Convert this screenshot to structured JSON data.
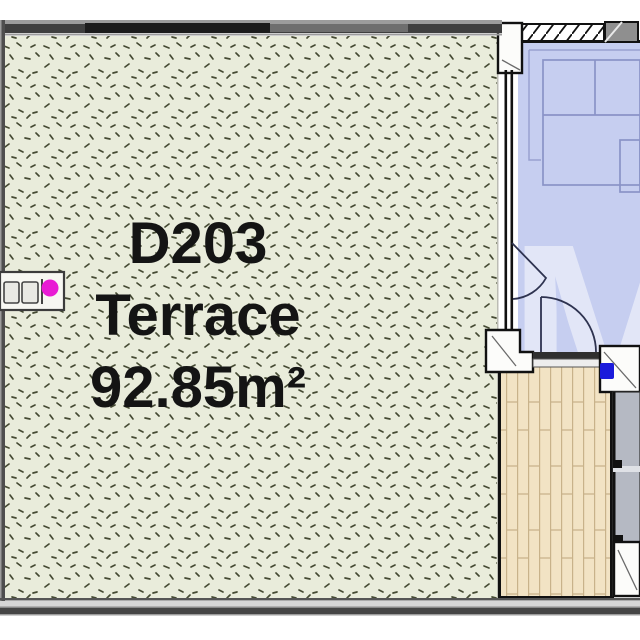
{
  "plan": {
    "unit_id": "D203",
    "room_label": "Terrace",
    "area_label": "92.85m²",
    "watermark": "M"
  },
  "icons": {
    "ac_unit": "ac-unit-icon",
    "door_swing": "door-swing-arc",
    "window_casement": "window-casement-arc"
  },
  "colors": {
    "terrace_fill": "#e9ecdb",
    "speckle": "#454a33",
    "wall": "#111111",
    "pillar_fill": "#fcfcfa",
    "railing_dark": "#3f3f3f",
    "railing_mid": "#6e6e6e",
    "railing_light": "#9c9c9c",
    "room_fill": "#c6cef0",
    "room_trim": "#98a1cf",
    "furniture_line": "#8a93c7",
    "deck_fill": "#f2e3c4",
    "plank_line": "#c8b28a",
    "glass_gray": "#b5b9c3",
    "concrete_gray": "#8f8f8f",
    "door_arc": "#2e3350",
    "marker_magenta": "#e81bd4",
    "marker_blue": "#1b1bdb",
    "label_color": "#141414",
    "watermark_color": "#ffffff"
  }
}
